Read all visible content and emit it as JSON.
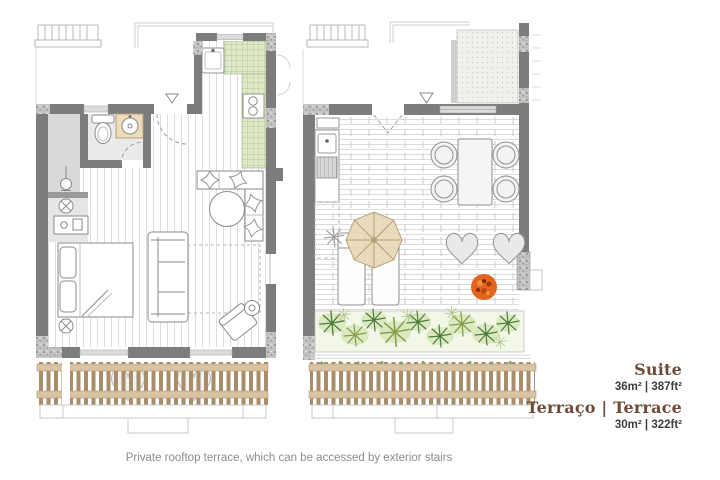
{
  "legend": {
    "items": [
      {
        "title": "Suite",
        "area": "36m² | 387ft²"
      },
      {
        "title": "Terraço | Terrace",
        "area": "30m² | 322ft²"
      }
    ]
  },
  "caption": "Private rooftop terrace, which can be accessed by exterior stairs",
  "colors": {
    "accent": "#6e4b38",
    "area_text": "#3d3d3d",
    "caption_text": "#8d8d8d",
    "wall": "#7c7c7c",
    "wood_slat": "#a98d6a",
    "wood_rail": "#d7c3a3",
    "tile_green": "#dfe9ca",
    "plant_dark": "#4e7c3b",
    "plant_light": "#cde2ae",
    "parasol": "#e9dabc",
    "orange_plant": "#e2641f"
  },
  "icons": {
    "entry_marker": "▽"
  }
}
